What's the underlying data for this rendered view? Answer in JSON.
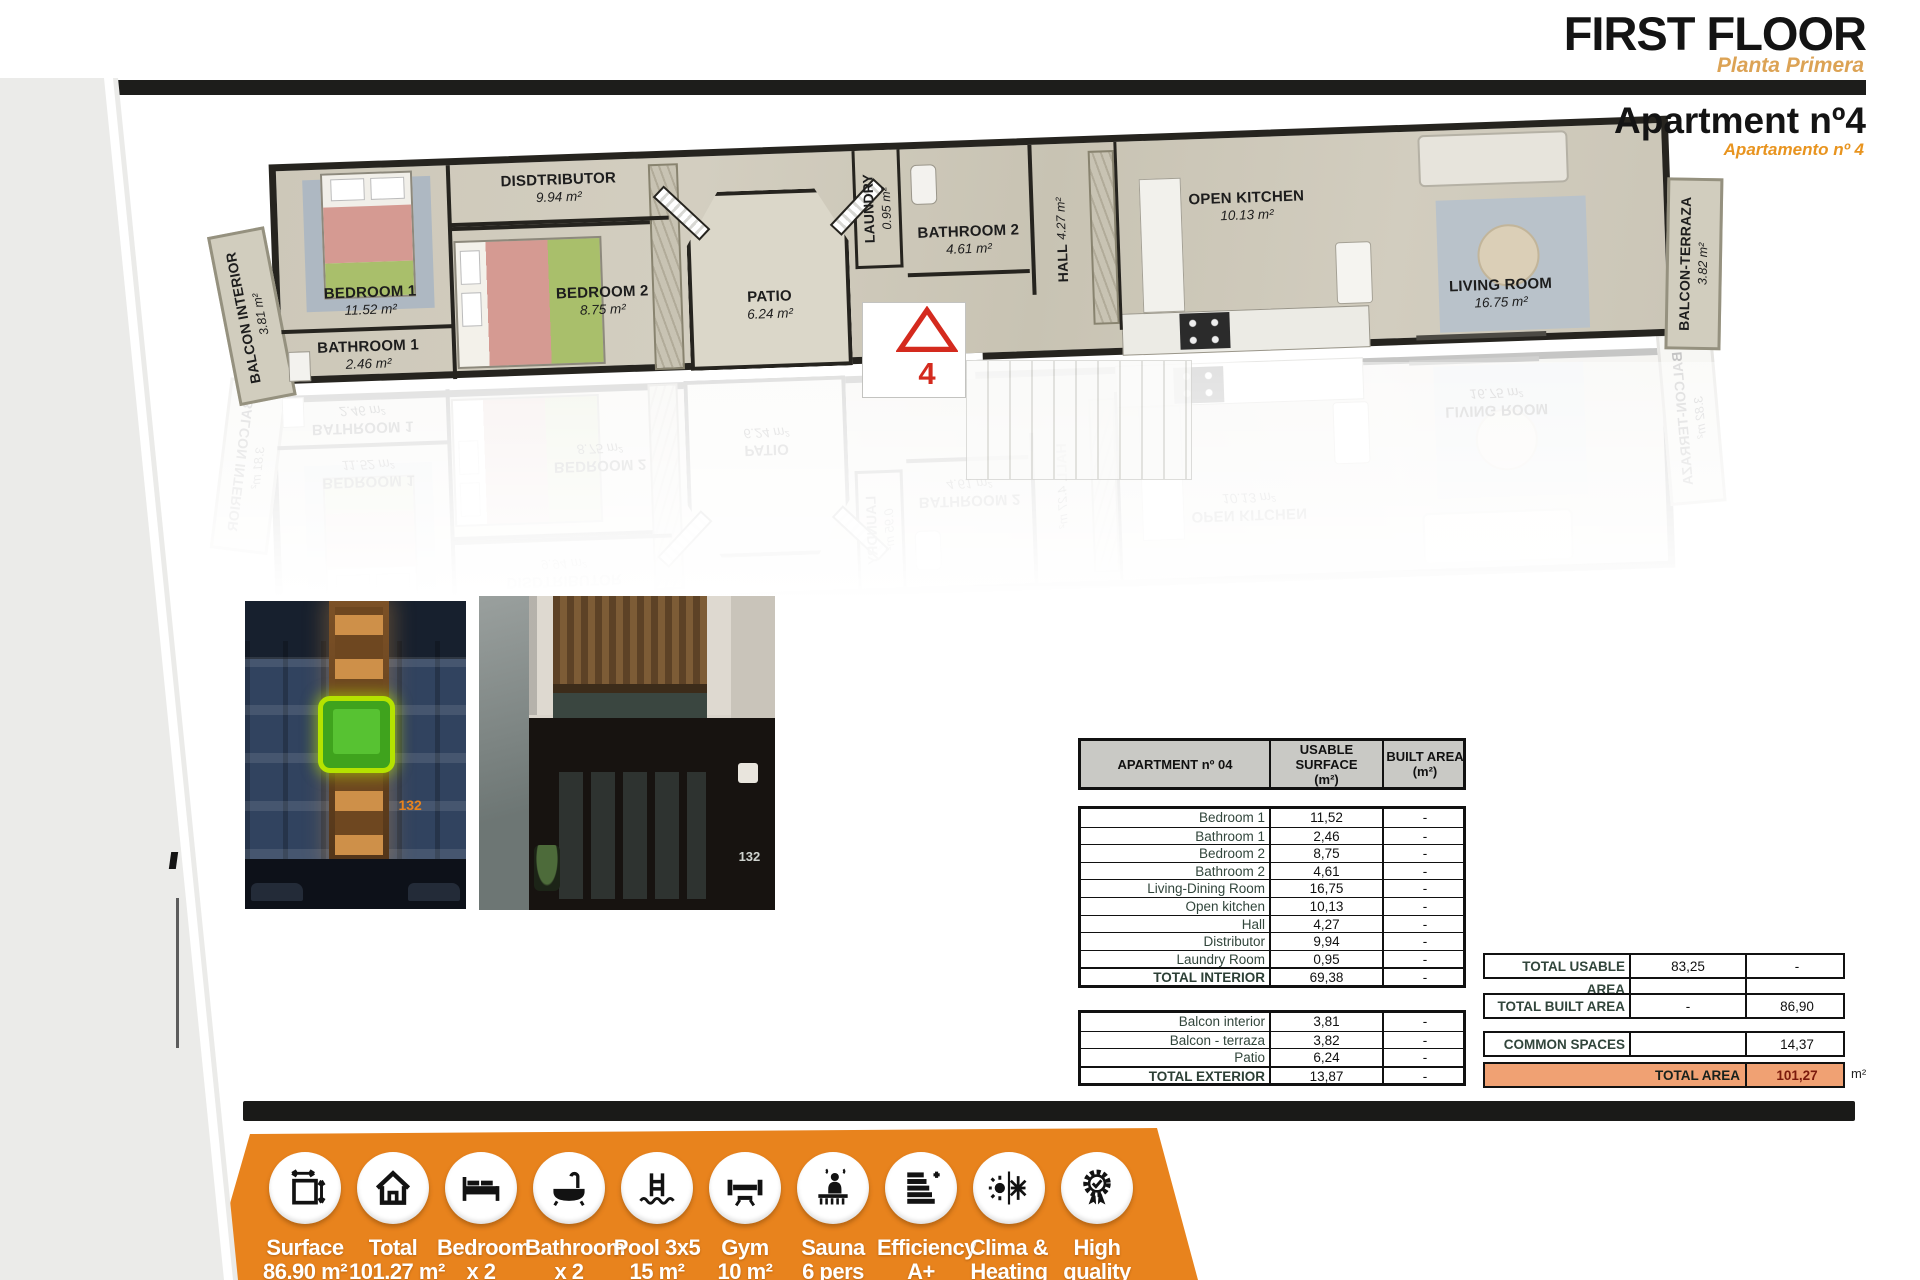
{
  "header": {
    "floor_title": "FIRST FLOOR",
    "floor_subtitle": "Planta Primera",
    "apartment_title": "Apartment nº4",
    "apartment_subtitle": "Apartamento nº 4"
  },
  "plan": {
    "unit_marker": "4",
    "rooms": [
      {
        "label": "BALCON INTERIOR",
        "area": "3.81 m²"
      },
      {
        "label": "BEDROOM 1",
        "area": "11.52 m²"
      },
      {
        "label": "BATHROOM 1",
        "area": "2.46 m²"
      },
      {
        "label": "DISDTRIBUTOR",
        "area": "9.94 m²"
      },
      {
        "label": "BEDROOM 2",
        "area": "8.75 m²"
      },
      {
        "label": "LAUNDRY",
        "area": "0.95 m²"
      },
      {
        "label": "PATIO",
        "area": "6.24 m²"
      },
      {
        "label": "BATHROOM 2",
        "area": "4.61 m²"
      },
      {
        "label": "HALL",
        "area": "4.27 m²"
      },
      {
        "label": "OPEN KITCHEN",
        "area": "10.13 m²"
      },
      {
        "label": "LIVING ROOM",
        "area": "16.75 m²"
      },
      {
        "label": "BALCON-TERRAZA",
        "area": "3.82 m²"
      }
    ]
  },
  "photos": {
    "left_building_number": "132",
    "right_building_number": "132"
  },
  "area_table": {
    "title": "APARTMENT nº 04",
    "col_usable": "USABLE SURFACE",
    "col_usable_unit": "(m²)",
    "col_built": "BUILT AREA",
    "col_built_unit": "(m²)",
    "interior_rows": [
      {
        "name": "Bedroom 1",
        "usable": "11,52",
        "built": "-"
      },
      {
        "name": "Bathroom 1",
        "usable": "2,46",
        "built": "-"
      },
      {
        "name": "Bedroom 2",
        "usable": "8,75",
        "built": "-"
      },
      {
        "name": "Bathroom 2",
        "usable": "4,61",
        "built": "-"
      },
      {
        "name": "Living-Dining Room",
        "usable": "16,75",
        "built": "-"
      },
      {
        "name": "Open kitchen",
        "usable": "10,13",
        "built": "-"
      },
      {
        "name": "Hall",
        "usable": "4,27",
        "built": "-"
      },
      {
        "name": "Distributor",
        "usable": "9,94",
        "built": "-"
      },
      {
        "name": "Laundry Room",
        "usable": "0,95",
        "built": "-"
      },
      {
        "name": "TOTAL INTERIOR",
        "usable": "69,38",
        "built": "-"
      }
    ],
    "exterior_rows": [
      {
        "name": "Balcon interior",
        "usable": "3,81",
        "built": "-"
      },
      {
        "name": "Balcon - terraza",
        "usable": "3,82",
        "built": "-"
      },
      {
        "name": "Patio",
        "usable": "6,24",
        "built": "-"
      },
      {
        "name": "TOTAL EXTERIOR",
        "usable": "13,87",
        "built": "-"
      }
    ]
  },
  "summary": {
    "usable": {
      "label": "TOTAL USABLE AREA",
      "usable": "83,25",
      "built": "-"
    },
    "built": {
      "label": "TOTAL BUILT AREA",
      "usable": "-",
      "built": "86,90"
    },
    "common": {
      "label": "COMMON SPACES",
      "usable": "",
      "built": "14,37"
    },
    "total": {
      "label": "TOTAL AREA",
      "value": "101,27",
      "unit": "m²"
    }
  },
  "banner": {
    "items": [
      {
        "label": "Surface",
        "sub": "86.90 m²"
      },
      {
        "label": "Total",
        "sub": "101.27 m²"
      },
      {
        "label": "Bedroom",
        "sub": "x 2"
      },
      {
        "label": "Bathroom",
        "sub": "x 2"
      },
      {
        "label": "Pool 3x5",
        "sub": "15 m²"
      },
      {
        "label": "Gym",
        "sub": "10 m²"
      },
      {
        "label": "Sauna",
        "sub": "6 pers"
      },
      {
        "label": "Efficiency",
        "sub": "A+"
      },
      {
        "label": "Clima &",
        "sub": "Heating"
      },
      {
        "label": "High",
        "sub": "quality"
      }
    ]
  }
}
